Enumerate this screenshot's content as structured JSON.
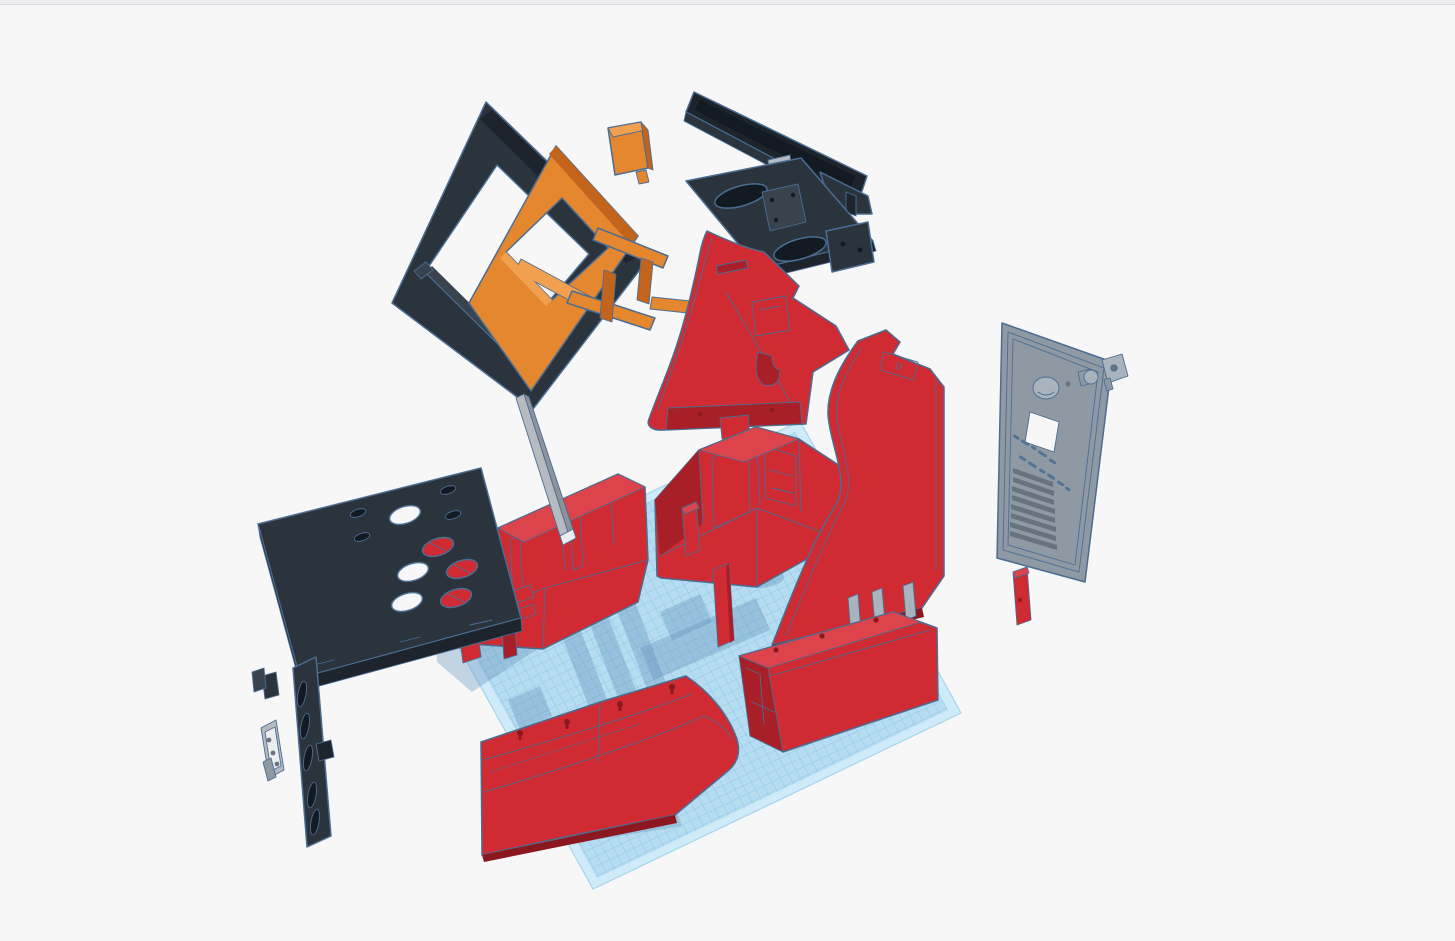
{
  "viewport": {
    "width": 1455,
    "height": 941,
    "background": "#f7f7f8",
    "top_bar": {
      "color": "#ededf2",
      "border": "#d9dae3"
    }
  },
  "palette": {
    "bg": "#f7f7f8",
    "topbar": "#ededf2",
    "topbar_border": "#d9dae3",
    "outline": "#4b6d92",
    "red": "#d02a33",
    "red_dark": "#a81f27",
    "red_deep": "#8c181f",
    "red_light": "#dc434b",
    "black": "#2b333d",
    "black_dark": "#1d242c",
    "black_deep": "#141a21",
    "black_light": "#39434e",
    "orange": "#e5872f",
    "orange_dark": "#c2641c",
    "orange_light": "#f0a04e",
    "gray": "#8e99a4",
    "gray_dark": "#67737f",
    "gray_light": "#a9b3bd",
    "steel": "#b6bbc2",
    "steel_dark": "#8d939b",
    "steel_light": "#ecedef",
    "white": "#f7f7f8",
    "grid_base": "#b5dcf0",
    "grid_line": "#8fc6e4",
    "grid_margin": "#cfeaf8",
    "grid_edge": "#a5d5ee",
    "shadow": "#5e90ba"
  },
  "scene": {
    "tool": "3d-cad-viewport",
    "workplane": {
      "name": "workplane",
      "shape": "parallelogram",
      "grid_cell_px": 9
    },
    "parts": [
      {
        "name": "screen-bezel-frame",
        "color": "black"
      },
      {
        "name": "monitor",
        "color": "black"
      },
      {
        "name": "monitor-mount-frame",
        "color": "orange"
      },
      {
        "name": "mount-block",
        "color": "orange"
      },
      {
        "name": "speaker-panel",
        "color": "black"
      },
      {
        "name": "cabinet-side-left",
        "color": "red"
      },
      {
        "name": "cabinet-side-right",
        "color": "red"
      },
      {
        "name": "back-box-left",
        "color": "red"
      },
      {
        "name": "back-box-right",
        "color": "red"
      },
      {
        "name": "front-panel-curved",
        "color": "red"
      },
      {
        "name": "base-box",
        "color": "red"
      },
      {
        "name": "control-panel",
        "color": "black"
      },
      {
        "name": "side-vent-panel",
        "color": "black"
      },
      {
        "name": "mounting-plate",
        "color": "steel"
      },
      {
        "name": "support-strip",
        "color": "steel"
      },
      {
        "name": "support-pillars",
        "color": "red"
      },
      {
        "name": "support-rails",
        "color": "red"
      },
      {
        "name": "back-access-panel",
        "color": "gray"
      },
      {
        "name": "latch-lock",
        "color": "gray"
      },
      {
        "name": "small-red-block",
        "color": "red"
      },
      {
        "name": "support-pegs",
        "color": "gray"
      }
    ]
  }
}
